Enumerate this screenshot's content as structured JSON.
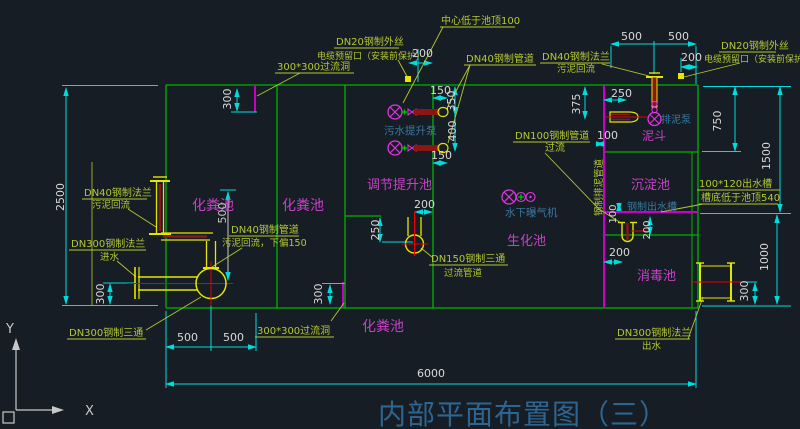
{
  "title": {
    "text": "内部平面布置图（三）"
  },
  "axis": {
    "x": "X",
    "y": "Y"
  },
  "tanks": {
    "septic_left": "化粪池",
    "septic_mid": "化粪池",
    "septic_bottom": "化粪池",
    "regulating_lift": "调节提升池",
    "biochemical": "生化池",
    "mud_hopper": "泥斗",
    "sedimentation": "沉淀池",
    "disinfection": "消毒池"
  },
  "equipment": {
    "sewage_lift_pump": "污水提升泵",
    "submerged_aerator": "水下曝气机",
    "mud_discharge_pump": "排泥泵",
    "steel_outlet_trough": "钢制出水槽"
  },
  "annotations": {
    "center_below_top": "中心低于池顶100",
    "dn20_line1": "DN20钢制外丝",
    "dn20_line2": "电缆预留口（安装前保护）",
    "dn40_pipe": "DN40钢制管道",
    "dn40_flange_line1": "DN40钢制法兰",
    "dn40_flange_line2": "污泥回流",
    "overflow_hole": "300*300过流洞",
    "dn100_line1": "DN100钢制管道",
    "dn100_line2": "过流",
    "steel_mud_pipe": "钢制排泥管道",
    "outlet_trough_line1": "100*120出水槽",
    "outlet_trough_line2": "槽底低于池顶540",
    "dn300_inlet_line1": "DN300钢制法兰",
    "dn300_inlet_line2": "进水",
    "dn40_offset_line1": "DN40钢制管道",
    "dn40_offset_line2": "污泥回流，下偏150",
    "dn150_tee_line1": "DN150钢制三通",
    "dn150_tee_line2": "过流管道",
    "dn300_tee": "DN300钢制三通",
    "dn300_outlet_line1": "DN300钢制法兰",
    "dn300_outlet_line2": "出水"
  },
  "dimensions": {
    "d6000": "6000",
    "d2500": "2500",
    "d1500": "1500",
    "d1000": "1000",
    "d750": "750",
    "d500": "500",
    "d400": "400",
    "d375": "375",
    "d350": "350",
    "d300": "300",
    "d250": "250",
    "d200": "200",
    "d150": "150",
    "d100": "100"
  },
  "colors": {
    "background": "#171d24",
    "wall_green": "#00b400",
    "label_green": "#b4c832",
    "dimension_cyan": "#00dcdc",
    "dimension_text": "#d8d8d8",
    "tank_magenta": "#c840c8",
    "hole_magenta": "#c800c8",
    "equipment_blue": "#3878a0",
    "pipe_yellow": "#e6e600",
    "pipe_dark_red": "#8b1616",
    "centerline_red": "#e60000",
    "title_blue": "#2d6590"
  }
}
